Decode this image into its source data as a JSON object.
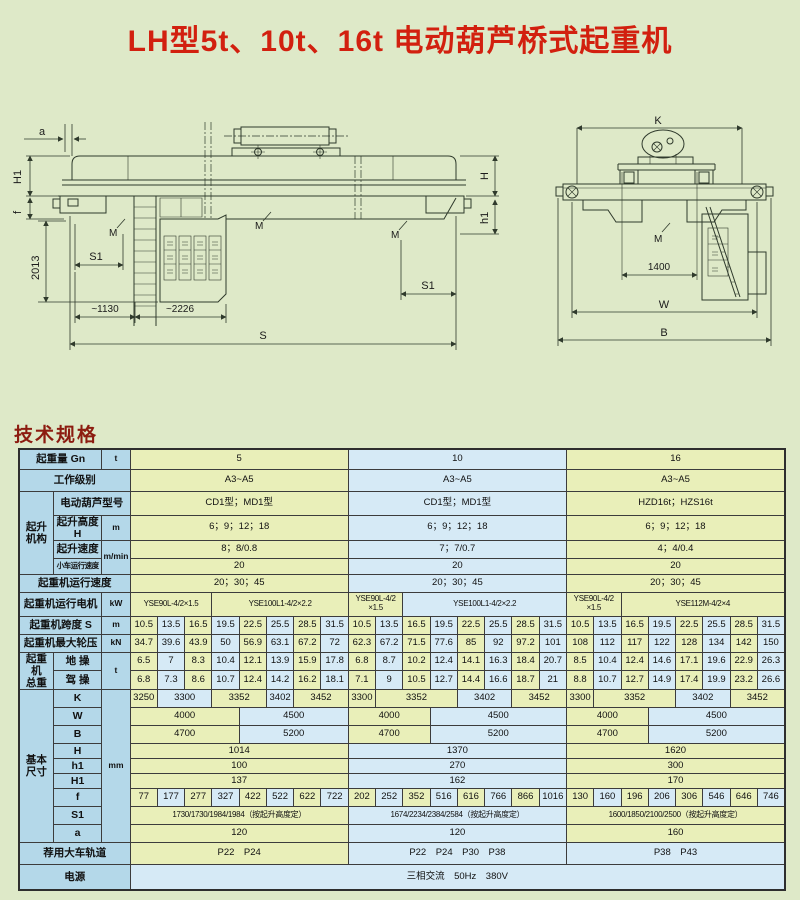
{
  "title": "LH型5t、10t、16t 电动葫芦桥式起重机",
  "section_heading": "技术规格",
  "colors": {
    "page_bg": "#dee9c8",
    "title": "#d2200f",
    "heading": "#8c1c10"
  },
  "drawings": {
    "front": {
      "a": "a",
      "H1": "H1",
      "f": "f",
      "v2013": "2013",
      "S1": "S1",
      "d1130": "~1130",
      "d2226": "~2226",
      "S": "S",
      "H": "H",
      "h1": "h1",
      "M": "M"
    },
    "end": {
      "K": "K",
      "d1400": "1400",
      "W": "W",
      "B": "B",
      "M": "M"
    }
  },
  "table": {
    "colors": {
      "yellow": "#e9efb9",
      "blue": "#d6eaf6",
      "header": "#b4d8e9"
    },
    "rows": [
      {
        "h": 20,
        "label": [
          "起重量 Gn",
          2
        ],
        "unit": [
          "t",
          1
        ],
        "cells": [
          [
            "5",
            8,
            "y"
          ],
          [
            "10",
            8,
            "b"
          ],
          [
            "16",
            8,
            "y"
          ]
        ]
      },
      {
        "h": 22,
        "label": [
          "工作级别",
          3
        ],
        "cells": [
          [
            "A3~A5",
            8,
            "y"
          ],
          [
            "A3~A5",
            8,
            "b"
          ],
          [
            "A3~A5",
            8,
            "y"
          ]
        ]
      },
      {
        "h": 24,
        "group": [
          "起升\n机构",
          4
        ],
        "label": [
          "电动葫芦型号",
          2
        ],
        "cells": [
          [
            "CD1型；MD1型",
            8,
            "y"
          ],
          [
            "CD1型；MD1型",
            8,
            "b"
          ],
          [
            "HZD16t；HZS16t",
            8,
            "y"
          ]
        ]
      },
      {
        "h": 22,
        "label": [
          "起升高度H",
          1
        ],
        "unit": [
          "m",
          1
        ],
        "cells": [
          [
            "6；9；12；18",
            8,
            "y"
          ],
          [
            "6；9；12；18",
            8,
            "b"
          ],
          [
            "6；9；12；18",
            8,
            "y"
          ]
        ]
      },
      {
        "h": 18,
        "label": [
          "起升速度",
          1
        ],
        "unit": [
          "m/min",
          2
        ],
        "cells": [
          [
            "8；8/0.8",
            8,
            "y"
          ],
          [
            "7；7/0.7",
            8,
            "b"
          ],
          [
            "4；4/0.4",
            8,
            "y"
          ]
        ]
      },
      {
        "h": 16,
        "label": [
          "小车运行速度",
          1
        ],
        "ls": 1,
        "cells": [
          [
            "20",
            8,
            "y"
          ],
          [
            "20",
            8,
            "b"
          ],
          [
            "20",
            8,
            "y"
          ]
        ]
      },
      {
        "h": 18,
        "label": [
          "起重机运行速度",
          3
        ],
        "cells": [
          [
            "20；30；45",
            8,
            "y"
          ],
          [
            "20；30；45",
            8,
            "b"
          ],
          [
            "20；30；45",
            8,
            "y"
          ]
        ]
      },
      {
        "h": 24,
        "label": [
          "起重机运行电机",
          2
        ],
        "unit": [
          "kW",
          1
        ],
        "fs": 1,
        "cells": [
          [
            "YSE90L-4/2×1.5",
            3,
            "y"
          ],
          [
            "YSE100L1-4/2×2.2",
            5,
            "y"
          ],
          [
            "YSE90L-4/2\n×1.5",
            2,
            "y"
          ],
          [
            "YSE100L1-4/2×2.2",
            6,
            "b"
          ],
          [
            "YSE90L-4/2\n×1.5",
            2,
            "y"
          ],
          [
            "YSE112M-4/2×4",
            6,
            "y"
          ]
        ]
      },
      {
        "h": 18,
        "label": [
          "起重机跨度 S",
          2
        ],
        "unit": [
          "m",
          1
        ],
        "cells": [
          [
            "10.5"
          ],
          [
            "13.5"
          ],
          [
            "16.5"
          ],
          [
            "19.5"
          ],
          [
            "22.5"
          ],
          [
            "25.5"
          ],
          [
            "28.5"
          ],
          [
            "31.5"
          ],
          [
            "10.5"
          ],
          [
            "13.5"
          ],
          [
            "16.5"
          ],
          [
            "19.5"
          ],
          [
            "22.5"
          ],
          [
            "25.5"
          ],
          [
            "28.5"
          ],
          [
            "31.5"
          ],
          [
            "10.5"
          ],
          [
            "13.5"
          ],
          [
            "16.5"
          ],
          [
            "19.5"
          ],
          [
            "22.5"
          ],
          [
            "25.5"
          ],
          [
            "28.5"
          ],
          [
            "31.5"
          ]
        ]
      },
      {
        "h": 18,
        "label": [
          "起重机最大轮压",
          2
        ],
        "unit": [
          "kN",
          1
        ],
        "cells": [
          [
            "34.7"
          ],
          [
            "39.6"
          ],
          [
            "43.9"
          ],
          [
            "50"
          ],
          [
            "56.9"
          ],
          [
            "63.1"
          ],
          [
            "67.2"
          ],
          [
            "72"
          ],
          [
            "62.3"
          ],
          [
            "67.2"
          ],
          [
            "71.5"
          ],
          [
            "77.6"
          ],
          [
            "85"
          ],
          [
            "92"
          ],
          [
            "97.2"
          ],
          [
            "101"
          ],
          [
            "108"
          ],
          [
            "112"
          ],
          [
            "117"
          ],
          [
            "122"
          ],
          [
            "128"
          ],
          [
            "134"
          ],
          [
            "142"
          ],
          [
            "150"
          ]
        ]
      },
      {
        "h": 18,
        "group": [
          "起重\n机\n总重",
          2
        ],
        "label": [
          "地 操",
          1
        ],
        "unit": [
          "t",
          2
        ],
        "cells": [
          [
            "6.5"
          ],
          [
            "7"
          ],
          [
            "8.3"
          ],
          [
            "10.4"
          ],
          [
            "12.1"
          ],
          [
            "13.9"
          ],
          [
            "15.9"
          ],
          [
            "17.8"
          ],
          [
            "6.8"
          ],
          [
            "8.7"
          ],
          [
            "10.2"
          ],
          [
            "12.4"
          ],
          [
            "14.1"
          ],
          [
            "16.3"
          ],
          [
            "18.4"
          ],
          [
            "20.7"
          ],
          [
            "8.5"
          ],
          [
            "10.4"
          ],
          [
            "12.4"
          ],
          [
            "14.6"
          ],
          [
            "17.1"
          ],
          [
            "19.6"
          ],
          [
            "22.9"
          ],
          [
            "26.3"
          ]
        ]
      },
      {
        "h": 18,
        "label": [
          "驾 操",
          1
        ],
        "cells": [
          [
            "6.8"
          ],
          [
            "7.3"
          ],
          [
            "8.6"
          ],
          [
            "10.7"
          ],
          [
            "12.4"
          ],
          [
            "14.2"
          ],
          [
            "16.2"
          ],
          [
            "18.1"
          ],
          [
            "7.1"
          ],
          [
            "9"
          ],
          [
            "10.5"
          ],
          [
            "12.7"
          ],
          [
            "14.4"
          ],
          [
            "16.6"
          ],
          [
            "18.7"
          ],
          [
            "21"
          ],
          [
            "8.8"
          ],
          [
            "10.7"
          ],
          [
            "12.7"
          ],
          [
            "14.9"
          ],
          [
            "17.4"
          ],
          [
            "19.9"
          ],
          [
            "23.2"
          ],
          [
            "26.6"
          ]
        ]
      },
      {
        "h": 18,
        "group": [
          "基本\n尺寸",
          9
        ],
        "label": [
          "K",
          1
        ],
        "unit": [
          "mm",
          9
        ],
        "cells": [
          [
            "3250",
            1,
            "y"
          ],
          [
            "3300",
            2,
            "b"
          ],
          [
            "3352",
            2,
            "y"
          ],
          [
            "3402",
            1,
            "b"
          ],
          [
            "3452",
            2,
            "y"
          ],
          [
            "3300",
            1,
            "y"
          ],
          [
            "3352",
            3,
            "y"
          ],
          [
            "3402",
            2,
            "b"
          ],
          [
            "3452",
            2,
            "y"
          ],
          [
            "3300",
            1,
            "y"
          ],
          [
            "3352",
            3,
            "y"
          ],
          [
            "3402",
            2,
            "b"
          ],
          [
            "3452",
            2,
            "y"
          ]
        ]
      },
      {
        "h": 18,
        "label": [
          "W",
          1
        ],
        "cells": [
          [
            "4000",
            4,
            "y"
          ],
          [
            "4500",
            4,
            "b"
          ],
          [
            "4000",
            3,
            "y"
          ],
          [
            "4500",
            5,
            "b"
          ],
          [
            "4000",
            3,
            "y"
          ],
          [
            "4500",
            5,
            "b"
          ]
        ]
      },
      {
        "h": 18,
        "label": [
          "B",
          1
        ],
        "cells": [
          [
            "4700",
            4,
            "y"
          ],
          [
            "5200",
            4,
            "b"
          ],
          [
            "4700",
            3,
            "y"
          ],
          [
            "5200",
            5,
            "b"
          ],
          [
            "4700",
            3,
            "y"
          ],
          [
            "5200",
            5,
            "b"
          ]
        ]
      },
      {
        "h": 15,
        "label": [
          "H",
          1
        ],
        "cells": [
          [
            "1014",
            8,
            "y"
          ],
          [
            "1370",
            8,
            "b"
          ],
          [
            "1620",
            8,
            "y"
          ]
        ]
      },
      {
        "h": 15,
        "label": [
          "h1",
          1
        ],
        "cells": [
          [
            "100",
            8,
            "y"
          ],
          [
            "270",
            8,
            "b"
          ],
          [
            "300",
            8,
            "y"
          ]
        ]
      },
      {
        "h": 15,
        "label": [
          "H1",
          1
        ],
        "cells": [
          [
            "137",
            8,
            "y"
          ],
          [
            "162",
            8,
            "b"
          ],
          [
            "170",
            8,
            "y"
          ]
        ]
      },
      {
        "h": 18,
        "label": [
          "f",
          1
        ],
        "cells": [
          [
            "77"
          ],
          [
            "177"
          ],
          [
            "277"
          ],
          [
            "327"
          ],
          [
            "422"
          ],
          [
            "522"
          ],
          [
            "622"
          ],
          [
            "722"
          ],
          [
            "202"
          ],
          [
            "252"
          ],
          [
            "352"
          ],
          [
            "516"
          ],
          [
            "616"
          ],
          [
            "766"
          ],
          [
            "866"
          ],
          [
            "1016"
          ],
          [
            "130"
          ],
          [
            "160"
          ],
          [
            "196"
          ],
          [
            "206"
          ],
          [
            "306"
          ],
          [
            "546"
          ],
          [
            "646"
          ],
          [
            "746"
          ]
        ]
      },
      {
        "h": 18,
        "label": [
          "S1",
          1
        ],
        "fs": 1,
        "cells": [
          [
            "1730/1730/1984/1984（按起升高度定）",
            8,
            "y"
          ],
          [
            "1674/2234/2384/2584（按起升高度定）",
            8,
            "b"
          ],
          [
            "1600/1850/2100/2500（按起升高度定）",
            8,
            "y"
          ]
        ]
      },
      {
        "h": 18,
        "label": [
          "a",
          1
        ],
        "cells": [
          [
            "120",
            8,
            "y"
          ],
          [
            "120",
            8,
            "b"
          ],
          [
            "160",
            8,
            "y"
          ]
        ]
      },
      {
        "h": 22,
        "label": [
          "荐用大车轨道",
          3
        ],
        "cells": [
          [
            "P22　P24",
            8,
            "y"
          ],
          [
            "P22　P24　P30　P38",
            8,
            "b"
          ],
          [
            "P38　P43",
            8,
            "b"
          ]
        ]
      },
      {
        "h": 26,
        "label": [
          "电源",
          3
        ],
        "cells": [
          [
            "三相交流　50Hz　380V",
            24,
            "b"
          ]
        ]
      }
    ]
  }
}
